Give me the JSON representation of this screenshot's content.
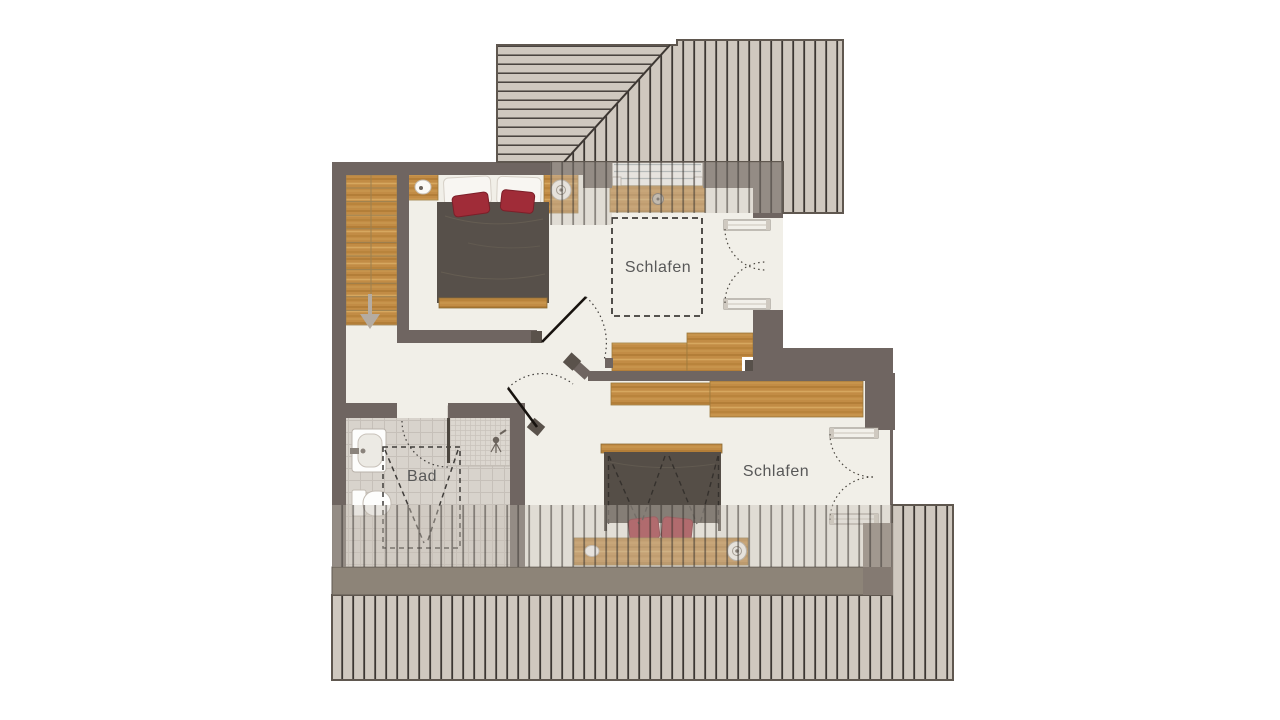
{
  "rooms": [
    {
      "id": "bedroom-1",
      "label": "Schlafen"
    },
    {
      "id": "bedroom-2",
      "label": "Schlafen"
    },
    {
      "id": "bathroom",
      "label": "Bad"
    }
  ],
  "icons": {
    "stair_direction": "down-arrow",
    "bedside_lamp": "circle-lamp",
    "shower_head": "spray"
  },
  "colors": {
    "wall": "#6f6561",
    "wall_cap": "#5a524b",
    "floor": "#f1efe8",
    "wood": "#c28c45",
    "roof_base": "#cfc8bf",
    "roof_line": "#3b3632",
    "roof_band": "#8d8478",
    "tile": "#d8d3cc",
    "duvet": "#56504a",
    "accent_red": "#a02c38",
    "label_text": "#585858"
  }
}
